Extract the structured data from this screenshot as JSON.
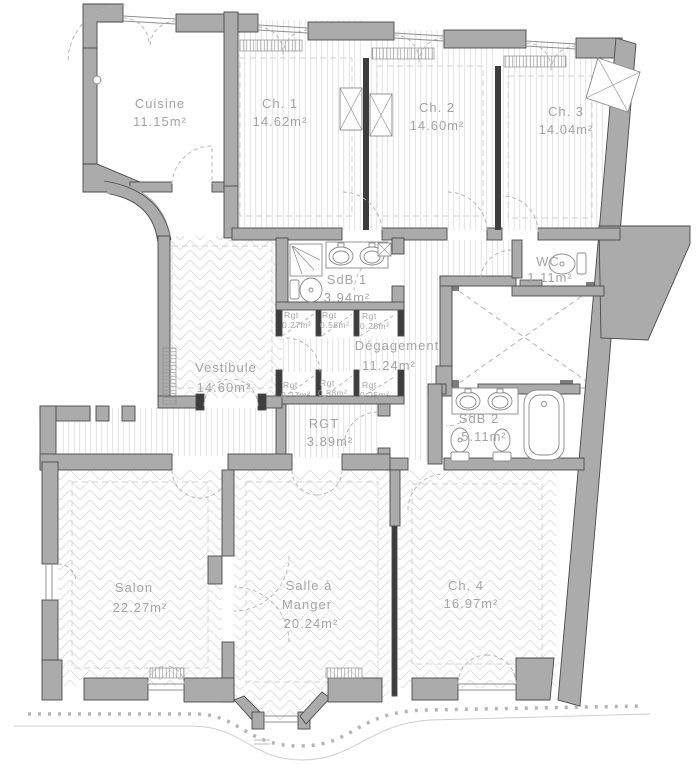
{
  "plan": {
    "rooms": {
      "cuisine": {
        "name": "Cuisine",
        "area": "11.15m²"
      },
      "ch1": {
        "name": "Ch. 1",
        "area": "14.62m²"
      },
      "ch2": {
        "name": "Ch. 2",
        "area": "14.60m²"
      },
      "ch3": {
        "name": "Ch. 3",
        "area": "14.04m²"
      },
      "sdb1": {
        "name": "SdB 1",
        "area": "3.94m²"
      },
      "wc": {
        "name": "WC",
        "area": "1.11m²"
      },
      "degagement": {
        "name": "Dégagement",
        "area": "11.24m²"
      },
      "vestibule": {
        "name": "Vestibule",
        "area": "14.60m²"
      },
      "rgt": {
        "name": "RGT",
        "area": "3.89m²"
      },
      "sdb2": {
        "name": "SdB 2",
        "area": "5.11m²"
      },
      "salon": {
        "name": "Salon",
        "area": "22.27m²"
      },
      "salle": {
        "name_line1": "Salle à",
        "name_line2": "Manger",
        "area": "20.24m²"
      },
      "ch4": {
        "name": "Ch. 4",
        "area": "16.97m²"
      }
    },
    "closets": {
      "row1": [
        {
          "name": "Rgt",
          "area": "0.27m²"
        },
        {
          "name": "Rgt",
          "area": "0.58m²"
        },
        {
          "name": "Rgt",
          "area": "0.28m²"
        }
      ],
      "row2": [
        {
          "name": "Rgt",
          "area": "0.27m²"
        },
        {
          "name": "Rgt",
          "area": "0.58m²"
        },
        {
          "name": "Rgt",
          "area": "0.25m²"
        }
      ]
    },
    "colors": {
      "wall_fill": "#ababab",
      "wall_stroke": "#4a4a4a",
      "dark_partition": "#3d3d3d",
      "hatch": "#d9d9d9",
      "label_text": "#a4a4a4"
    }
  }
}
